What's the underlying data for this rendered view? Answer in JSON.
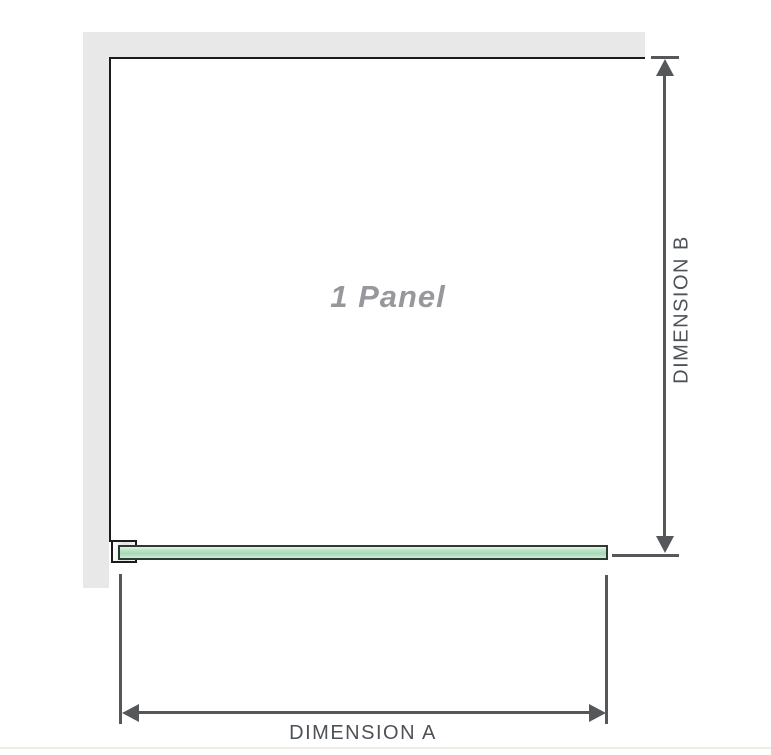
{
  "diagram": {
    "panel_label": "1 Panel",
    "dimensions": {
      "a_label": "DIMENSION A",
      "b_label": "DIMENSION B"
    },
    "colors": {
      "wall_gray": "#e8e8e8",
      "outline_black": "#1b1b1b",
      "glass_green": "#aedcbc",
      "glass_border": "#2c3a31",
      "dimension_gray": "#55575a",
      "panel_label_gray": "#98989c",
      "label_gray": "#4e5257"
    }
  }
}
